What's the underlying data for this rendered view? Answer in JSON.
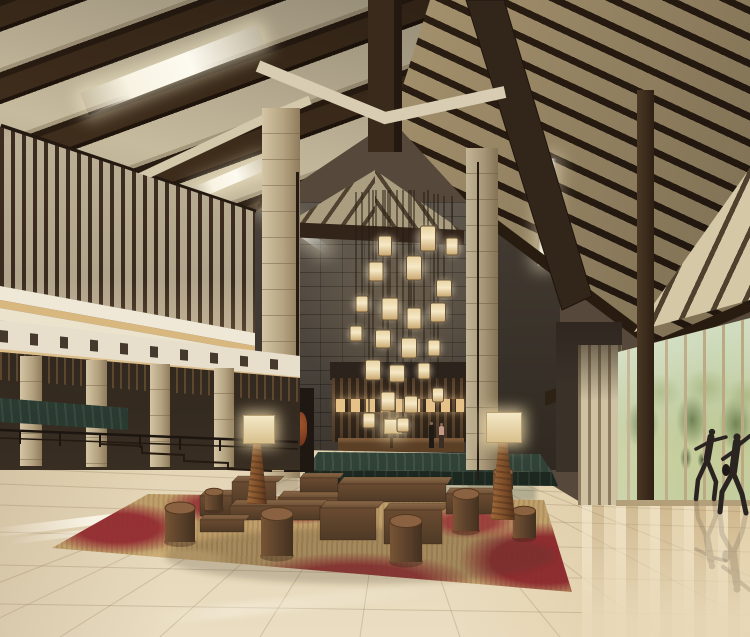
{
  "scene": {
    "type": "architectural-rendering",
    "subject": "hotel-lobby-interior",
    "description": "Large resort hotel lobby atrium with steep dark-timber gabled ceiling, linear skylights, woven ceiling panels, vertical wood slat screens, beige stone columns, a dark stone feature wall with a cluster of amber lantern pendants, a reception desk with two staff figures, a green marble platform, square timber benches and drum stools on a crimson-and-tan rug, polished beige marble floor with reflections, and a full-height window wall on the right looking onto lawns and trees with two figures practicing tai chi.",
    "people": {
      "at_reception": 2,
      "at_window": 2
    },
    "lantern_count": 22,
    "stool_count": 7
  },
  "palette": {
    "beamDark": "#2a1d12",
    "beamMid": "#3f2d1c",
    "roofPanelLeft": "#c7bb9e",
    "roofPanelRight": "#a3906c",
    "skylight": "#f8f3e2",
    "slatLight": "#c3b79c",
    "slatDark": "#3e2d20",
    "cream": "#efe8d6",
    "stoneCol": "#cfc0a0",
    "darkStone": "#4e463e",
    "marbleGreen": "#3a5046",
    "floorA": "#c6b28c",
    "floorB": "#eaddc1",
    "rugRed": "#932c32",
    "rugTan": "#bfa06a",
    "benchFront": "#5a4129",
    "benchTop": "#7d5c3e",
    "glassSky": "#e6f1ee",
    "lawn": "#b7c490",
    "treeDark": "#6f8750",
    "lanternGlow": "#f0dfae",
    "coveGlow": "#d9b87f",
    "figure": "#2a2320"
  }
}
